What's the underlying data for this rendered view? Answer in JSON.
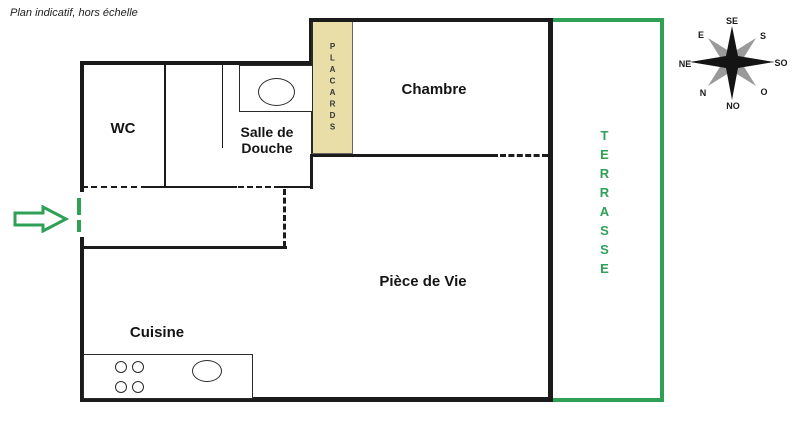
{
  "note": "Plan indicatif, hors échelle",
  "rooms": {
    "wc": "WC",
    "salle_de_douche": "Salle de Douche",
    "chambre": "Chambre",
    "piece_de_vie": "Pièce de Vie",
    "cuisine": "Cuisine",
    "placards": "PLACARDS",
    "terrasse": "TERRASSE"
  },
  "compass": {
    "se": "SE",
    "s": "S",
    "so": "SO",
    "o": "O",
    "no": "NO",
    "n": "N",
    "ne": "NE",
    "e": "E"
  },
  "colors": {
    "wall": "#1b1b1b",
    "green": "#2ea157",
    "placard_fill": "#e9dea8",
    "compass_gray": "#9a9a9a"
  }
}
